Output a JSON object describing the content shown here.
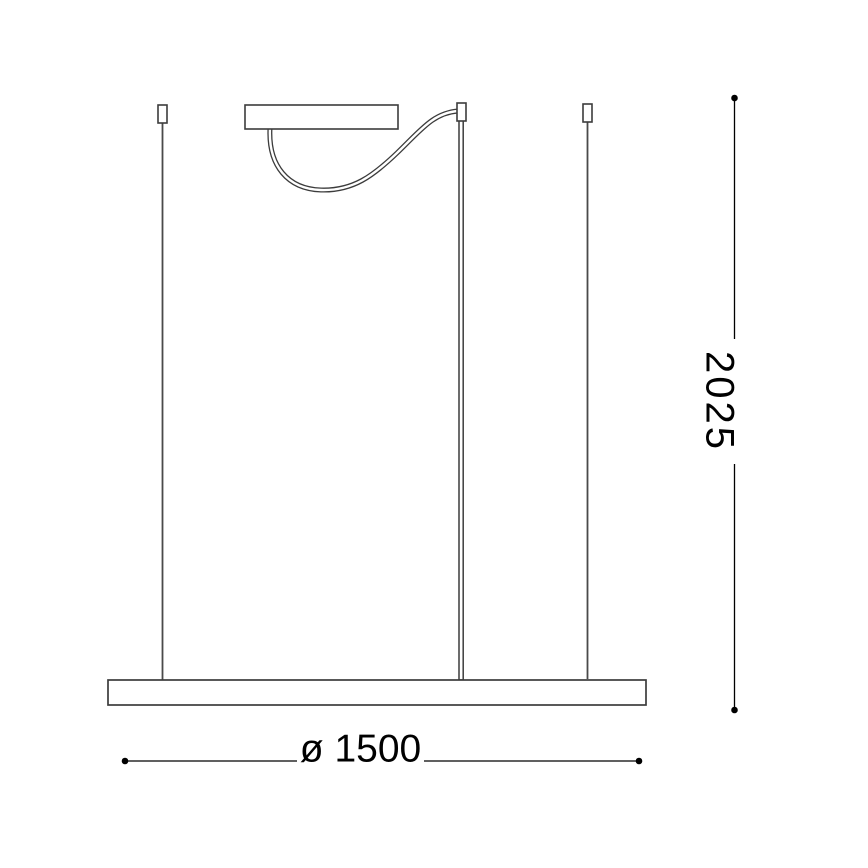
{
  "drawing": {
    "kind": "pendant-lamp-suspension-side-view",
    "colors": {
      "background": "#ffffff",
      "outline": "#3c3c3c",
      "wire": "#4a4a4a",
      "dimension": "#000000",
      "fill": "#ffffff"
    },
    "dimensions": {
      "height": {
        "label": "2025",
        "orientation": "vertical"
      },
      "diameter": {
        "label": "ø 1500",
        "orientation": "horizontal"
      }
    }
  }
}
